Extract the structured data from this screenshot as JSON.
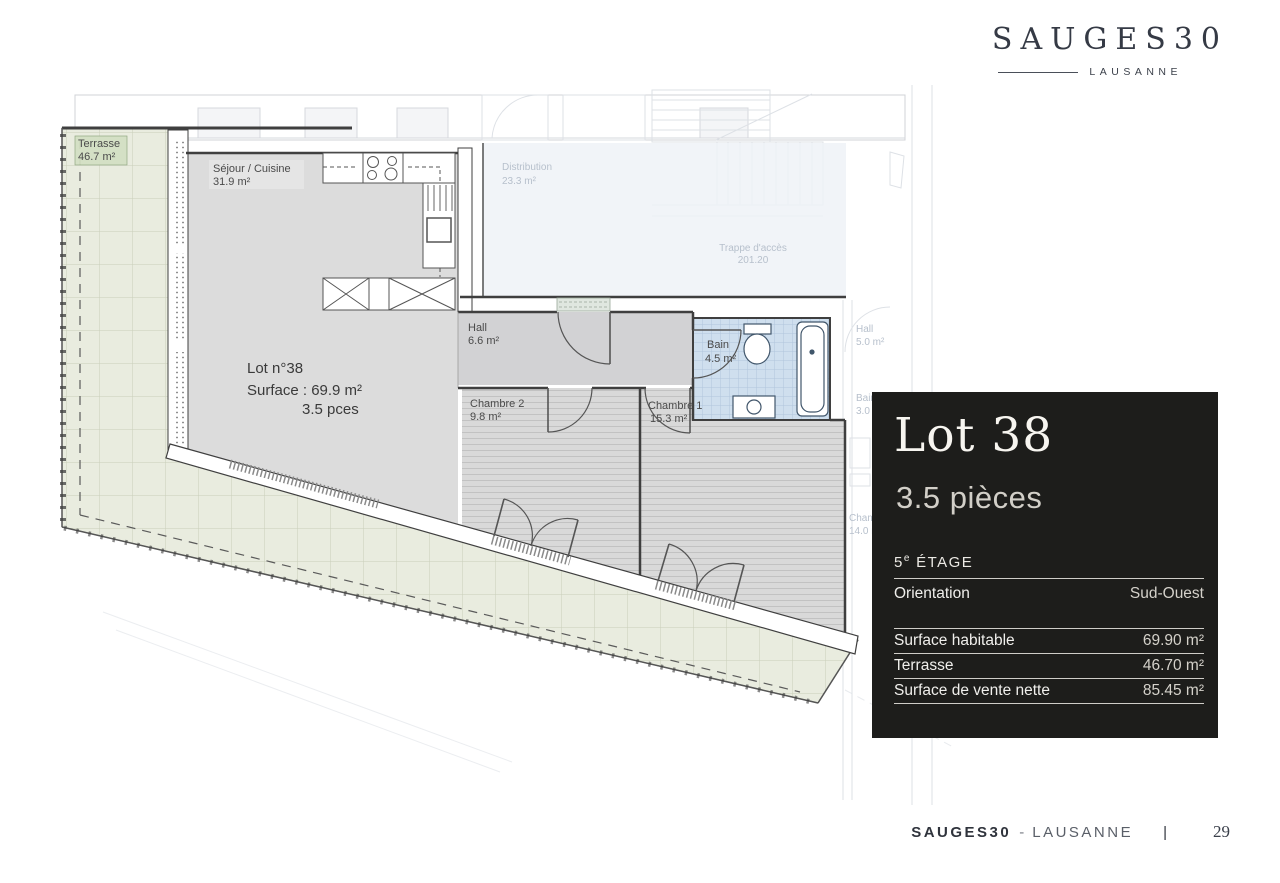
{
  "logo": {
    "title": "SAUGES30",
    "city": "LAUSANNE"
  },
  "panel": {
    "lot_title": "Lot 38",
    "rooms_title": "3.5 pièces",
    "floor_number": "5",
    "floor_sup": "e",
    "floor_word": "ÉTAGE",
    "orientation": {
      "label": "Orientation",
      "value": "Sud-Ouest"
    },
    "surfaces": [
      {
        "label": "Surface habitable",
        "value": "69.90 m²"
      },
      {
        "label": "Terrasse",
        "value": "46.70 m²"
      },
      {
        "label": "Surface de vente nette",
        "value": "85.45 m²"
      }
    ]
  },
  "plan": {
    "rooms": {
      "terrasse": {
        "name": "Terrasse",
        "area": "46.7 m²"
      },
      "sejour": {
        "name": "Séjour / Cuisine",
        "area": "31.9 m²"
      },
      "hall": {
        "name": "Hall",
        "area": "6.6 m²"
      },
      "chambre2": {
        "name": "Chambre 2",
        "area": "9.8 m²"
      },
      "chambre1": {
        "name": "Chambre 1",
        "area": "15.3 m²"
      },
      "bain": {
        "name": "Bain",
        "area": "4.5 m²"
      }
    },
    "center_label": {
      "line1": "Lot n°38",
      "line2": "Surface : 69.9 m²",
      "line3": "3.5 pces"
    },
    "context": {
      "distribution": {
        "name": "Distribution",
        "area": "23.3 m²"
      },
      "hatch": {
        "name": "Trappe d'accès",
        "value": "201.20"
      },
      "neighbor_hall": {
        "name": "Hall",
        "area": "5.0 m²"
      },
      "neighbor_bain": {
        "name": "Bain",
        "area": "3.0 m²"
      },
      "neighbor_chambre": {
        "name": "Chambre",
        "area": "14.0 m²"
      }
    }
  },
  "footer": {
    "brand": "SAUGES30",
    "separator": "-",
    "city": "LAUSANNE",
    "divider": "|",
    "page": "29"
  },
  "colors": {
    "terrace": "#e9ecdf",
    "floor_gray": "#dcdcdc",
    "hall_gray": "#d2d2d4",
    "bath_blue": "#cfdfee",
    "wall_line": "#3f3f3f",
    "panel_bg": "#1d1d1b",
    "brand_text": "#353a45"
  }
}
